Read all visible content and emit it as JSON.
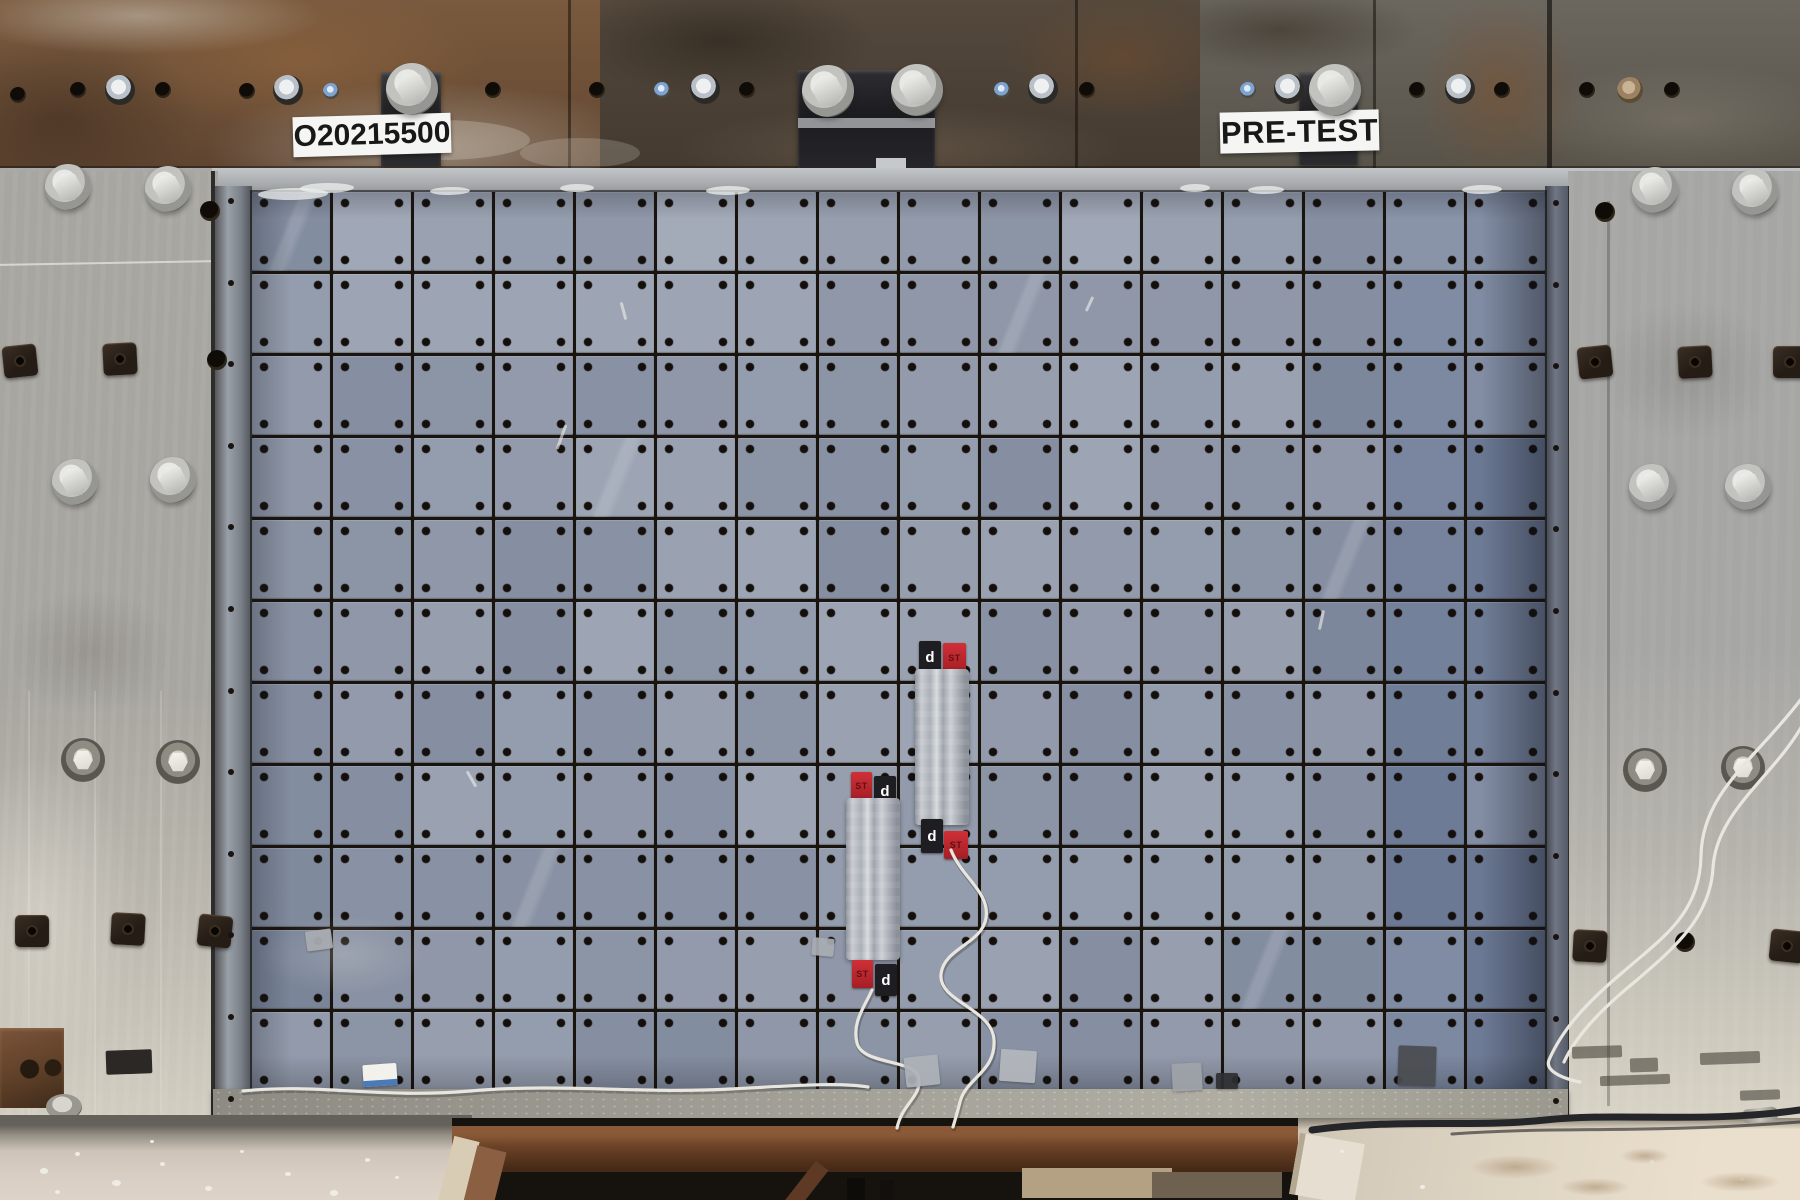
{
  "scene": {
    "width": 1800,
    "height": 1200,
    "description": "Outdoor pre-test photograph of a blast/ballistic test wall: blue-gray tiled target panel bolted between weathered steel columns beneath a rusted header beam, with two taped-on sensor strips and white lead wires"
  },
  "labels": {
    "test_id": "O20215500",
    "phase": "PRE-TEST"
  },
  "sensors": {
    "logo": "d",
    "code": "ST"
  },
  "panel": {
    "rows": 11,
    "cols": 16,
    "tile_hue": 220,
    "scratches": [
      [
        560,
        424,
        26,
        20
      ],
      [
        622,
        302,
        18,
        -15
      ],
      [
        1088,
        296,
        16,
        25
      ],
      [
        1320,
        610,
        20,
        12
      ],
      [
        470,
        770,
        18,
        -30
      ]
    ]
  },
  "hardware": {
    "band_holes": [
      [
        18,
        95
      ],
      [
        78,
        90
      ],
      [
        163,
        90
      ],
      [
        247,
        91
      ],
      [
        493,
        90
      ],
      [
        597,
        90
      ],
      [
        747,
        90
      ],
      [
        1087,
        90
      ],
      [
        1417,
        90
      ],
      [
        1502,
        90
      ],
      [
        1587,
        90
      ],
      [
        1672,
        90
      ]
    ],
    "band_bolts": [
      [
        120,
        90
      ],
      [
        288,
        90
      ],
      [
        705,
        89
      ],
      [
        1043,
        89
      ],
      [
        1289,
        89
      ],
      [
        1460,
        89
      ]
    ],
    "blue_screws": [
      [
        331,
        91
      ],
      [
        662,
        90
      ],
      [
        1002,
        90
      ],
      [
        1248,
        90
      ]
    ],
    "brown_bolts": [
      [
        1630,
        90
      ]
    ],
    "bracket_bolts": [
      [
        412,
        89
      ],
      [
        828,
        91
      ],
      [
        917,
        90
      ],
      [
        1335,
        90
      ]
    ],
    "hexa": [
      [
        68,
        187
      ],
      [
        168,
        189
      ],
      [
        75,
        482
      ],
      [
        173,
        480
      ],
      [
        1655,
        190
      ],
      [
        1755,
        192
      ],
      [
        1652,
        487
      ],
      [
        1748,
        487
      ]
    ],
    "hexb": [
      [
        83,
        760
      ],
      [
        178,
        762
      ],
      [
        1645,
        770
      ],
      [
        1743,
        768
      ]
    ],
    "squares": [
      [
        20,
        362
      ],
      [
        120,
        360
      ],
      [
        32,
        932
      ],
      [
        128,
        930
      ],
      [
        215,
        932
      ],
      [
        1595,
        363
      ],
      [
        1695,
        363
      ],
      [
        1790,
        363
      ],
      [
        1590,
        947
      ],
      [
        1787,
        947
      ]
    ],
    "col_holes": [
      [
        210,
        211
      ],
      [
        217,
        360
      ],
      [
        1605,
        212
      ],
      [
        1685,
        942
      ]
    ]
  },
  "patches": [
    {
      "x": 905,
      "y": 1056,
      "w": 34,
      "h": 30,
      "c": "#aeb2b8",
      "rot": -6
    },
    {
      "x": 1000,
      "y": 1050,
      "w": 36,
      "h": 32,
      "c": "#b4b8bd",
      "rot": 4
    },
    {
      "x": 1172,
      "y": 1063,
      "w": 30,
      "h": 28,
      "c": "#9fa3a9",
      "rot": -3
    },
    {
      "x": 1398,
      "y": 1046,
      "w": 38,
      "h": 40,
      "c": "#4a4c50",
      "rot": 2
    },
    {
      "x": 306,
      "y": 930,
      "w": 26,
      "h": 20,
      "c": "#a9adb2",
      "rot": -8
    },
    {
      "x": 812,
      "y": 938,
      "w": 22,
      "h": 18,
      "c": "#a9adb2",
      "rot": 5
    },
    {
      "x": 1216,
      "y": 1073,
      "w": 22,
      "h": 16,
      "c": "#2e2f31",
      "rot": 0
    }
  ],
  "card": {
    "x": 363,
    "y": 1064,
    "w": 34,
    "h": 22
  },
  "splatters_left": [
    [
      40,
      1168,
      8
    ],
    [
      75,
      1152,
      5
    ],
    [
      112,
      1180,
      9
    ],
    [
      160,
      1162,
      5
    ],
    [
      205,
      1186,
      7
    ],
    [
      240,
      1150,
      4
    ],
    [
      285,
      1172,
      6
    ],
    [
      330,
      1190,
      8
    ],
    [
      365,
      1158,
      5
    ],
    [
      150,
      1140,
      4
    ],
    [
      55,
      1190,
      5
    ],
    [
      395,
      1176,
      4
    ]
  ],
  "specks_right": [
    [
      1340,
      1150,
      4
    ],
    [
      1420,
      1185,
      5
    ],
    [
      1650,
      1160,
      4
    ],
    [
      1740,
      1178,
      4
    ]
  ],
  "stains_right": [
    [
      1470,
      1155,
      90,
      24
    ],
    [
      1560,
      1178,
      70,
      18
    ],
    [
      1620,
      1148,
      50,
      16
    ],
    [
      1700,
      1172,
      80,
      20
    ]
  ],
  "marks_rightcol": [
    [
      1572,
      1046,
      50,
      12
    ],
    [
      1600,
      1075,
      70,
      10
    ],
    [
      1630,
      1058,
      28,
      14
    ],
    [
      1700,
      1052,
      60,
      12
    ],
    [
      1740,
      1090,
      40,
      10
    ]
  ],
  "sill_smears": [
    [
      258,
      188,
      70,
      12
    ],
    [
      300,
      183,
      54,
      10
    ],
    [
      430,
      187,
      40,
      8
    ],
    [
      560,
      184,
      34,
      8
    ],
    [
      706,
      186,
      44,
      9
    ],
    [
      1180,
      184,
      30,
      8
    ],
    [
      1248,
      186,
      36,
      8
    ],
    [
      1462,
      185,
      40,
      9
    ]
  ],
  "colors": {
    "tile": "#97a0af",
    "tile_shadow": "#5f6878",
    "grid_line": "#16120e",
    "rust": "#6b4a30",
    "steel_column": "#aeaca4",
    "sill": "#b7babd",
    "label_bg": "#f5f5f3",
    "label_text": "#181818",
    "sensor_red": "#c22730",
    "sensor_black": "#1e1e22",
    "sensor_tape": "#c9ccd1",
    "wire_white": "#e9e6df",
    "cable_black": "#24262a",
    "concrete_left": "#d5cbc0",
    "concrete_right": "#e2d8c6",
    "pit": "#16130e",
    "beam_rust": "#6b4226"
  }
}
